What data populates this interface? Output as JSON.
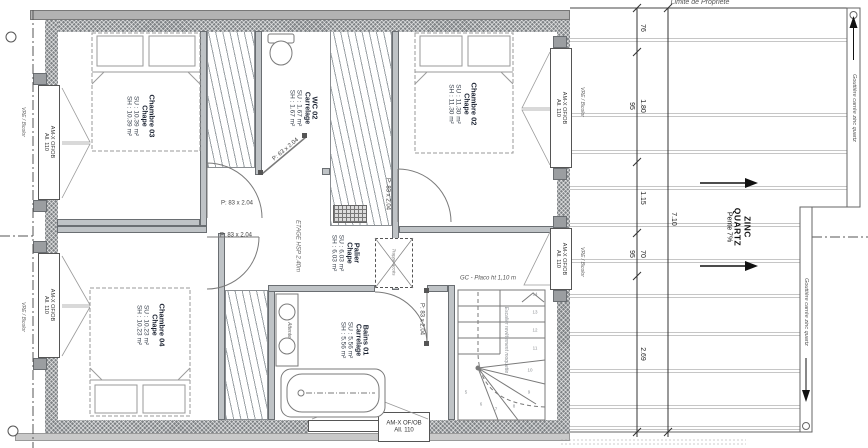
{
  "plan": {
    "property_line_label": "Limite de Propriété",
    "floor_note": "ETAGE HSP 2.40m",
    "rooms": {
      "ch03": {
        "name": "Chambre 03",
        "finish": "Chape",
        "su": "SU : 10.39 m²",
        "sh": "SH : 10.39 m²"
      },
      "wc02": {
        "name": "WC 02",
        "finish": "Carrelage",
        "su": "SU : 1.67 m²",
        "sh": "SH : 1.67 m²"
      },
      "ch02": {
        "name": "Chambre 02",
        "finish": "Chape",
        "su": "SU : 11.30 m²",
        "sh": "SH : 11.30 m²"
      },
      "palier": {
        "name": "Palier",
        "finish": "Chape",
        "su": "SU : 6.03 m²",
        "sh": "SH : 6.03 m²"
      },
      "ch04": {
        "name": "Chambre 04",
        "finish": "Chape",
        "su": "SU : 10.23 m²",
        "sh": "SH : 10.23 m²"
      },
      "bains": {
        "name": "Bains 01",
        "finish": "Carrelage",
        "su": "SU : 5.56 m²",
        "sh": "SH : 5.56 m²"
      }
    },
    "doors": {
      "d83": "P: 83 x 2.04",
      "d63": "P: 63 x 2.04"
    },
    "window": {
      "type": "AM-X OF/OB",
      "sill": "All. 110",
      "shutter": "VRE / Bicolor"
    },
    "stair": {
      "guard_label": "GC - Placo ht 1,10 m",
      "note": "Escalier revêtement moquette",
      "treads": [
        "1",
        "2",
        "3",
        "4",
        "5",
        "6",
        "7",
        "8",
        "9",
        "10",
        "11",
        "12",
        "13",
        "14"
      ]
    },
    "trap_label": "Trappe accès",
    "bath_note": "Attente",
    "roof": {
      "material_l1": "ZINC",
      "material_l2": "QUARTZ",
      "slope": "Pente 7%",
      "gutter_label": "Gouttière carrée zinc quartz",
      "dims": {
        "seg_76": "76",
        "seg_180": "1.80",
        "seg_115": "1.15",
        "seg_70": "70",
        "seg_269": "2.69",
        "aux_95a": "95",
        "aux_95b": "95",
        "total": "7.10"
      }
    }
  }
}
